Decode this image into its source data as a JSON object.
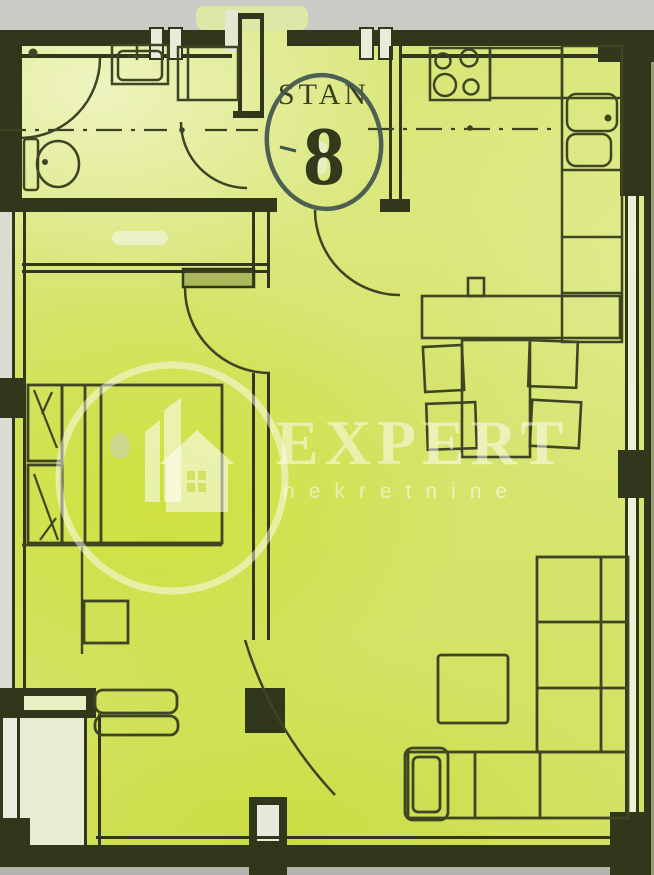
{
  "badge": {
    "label": "STAN",
    "number": "8"
  },
  "watermark": {
    "brand": "EXPERT",
    "tagline": "nekretnine"
  },
  "colors": {
    "paper": "#d9e77c",
    "paper_vivid": "#cbe03a",
    "paper_pale": "#e7eeab",
    "ink": "#30371a",
    "pen_circle": "#41544f",
    "watermark_white": "#ffffff",
    "scan_gray": "#cbcac6"
  },
  "fixtures": {
    "bathroom": [
      "shower",
      "washbasin",
      "cabinet",
      "toilet"
    ],
    "kitchen": [
      "stove",
      "counter",
      "kitchen-sink",
      "cabinet-run"
    ],
    "dining": [
      "sideboard",
      "dining-table",
      "chair",
      "chair",
      "chair",
      "chair"
    ],
    "bedroom": [
      "double-bed",
      "nightstand",
      "nightstand",
      "desk",
      "radiator-sill"
    ],
    "living": [
      "corner-sofa",
      "sofa-armrest",
      "coffee-table"
    ],
    "doors": [
      "bathroom-door",
      "bedroom-door",
      "living-room-door",
      "entrance-door"
    ]
  }
}
